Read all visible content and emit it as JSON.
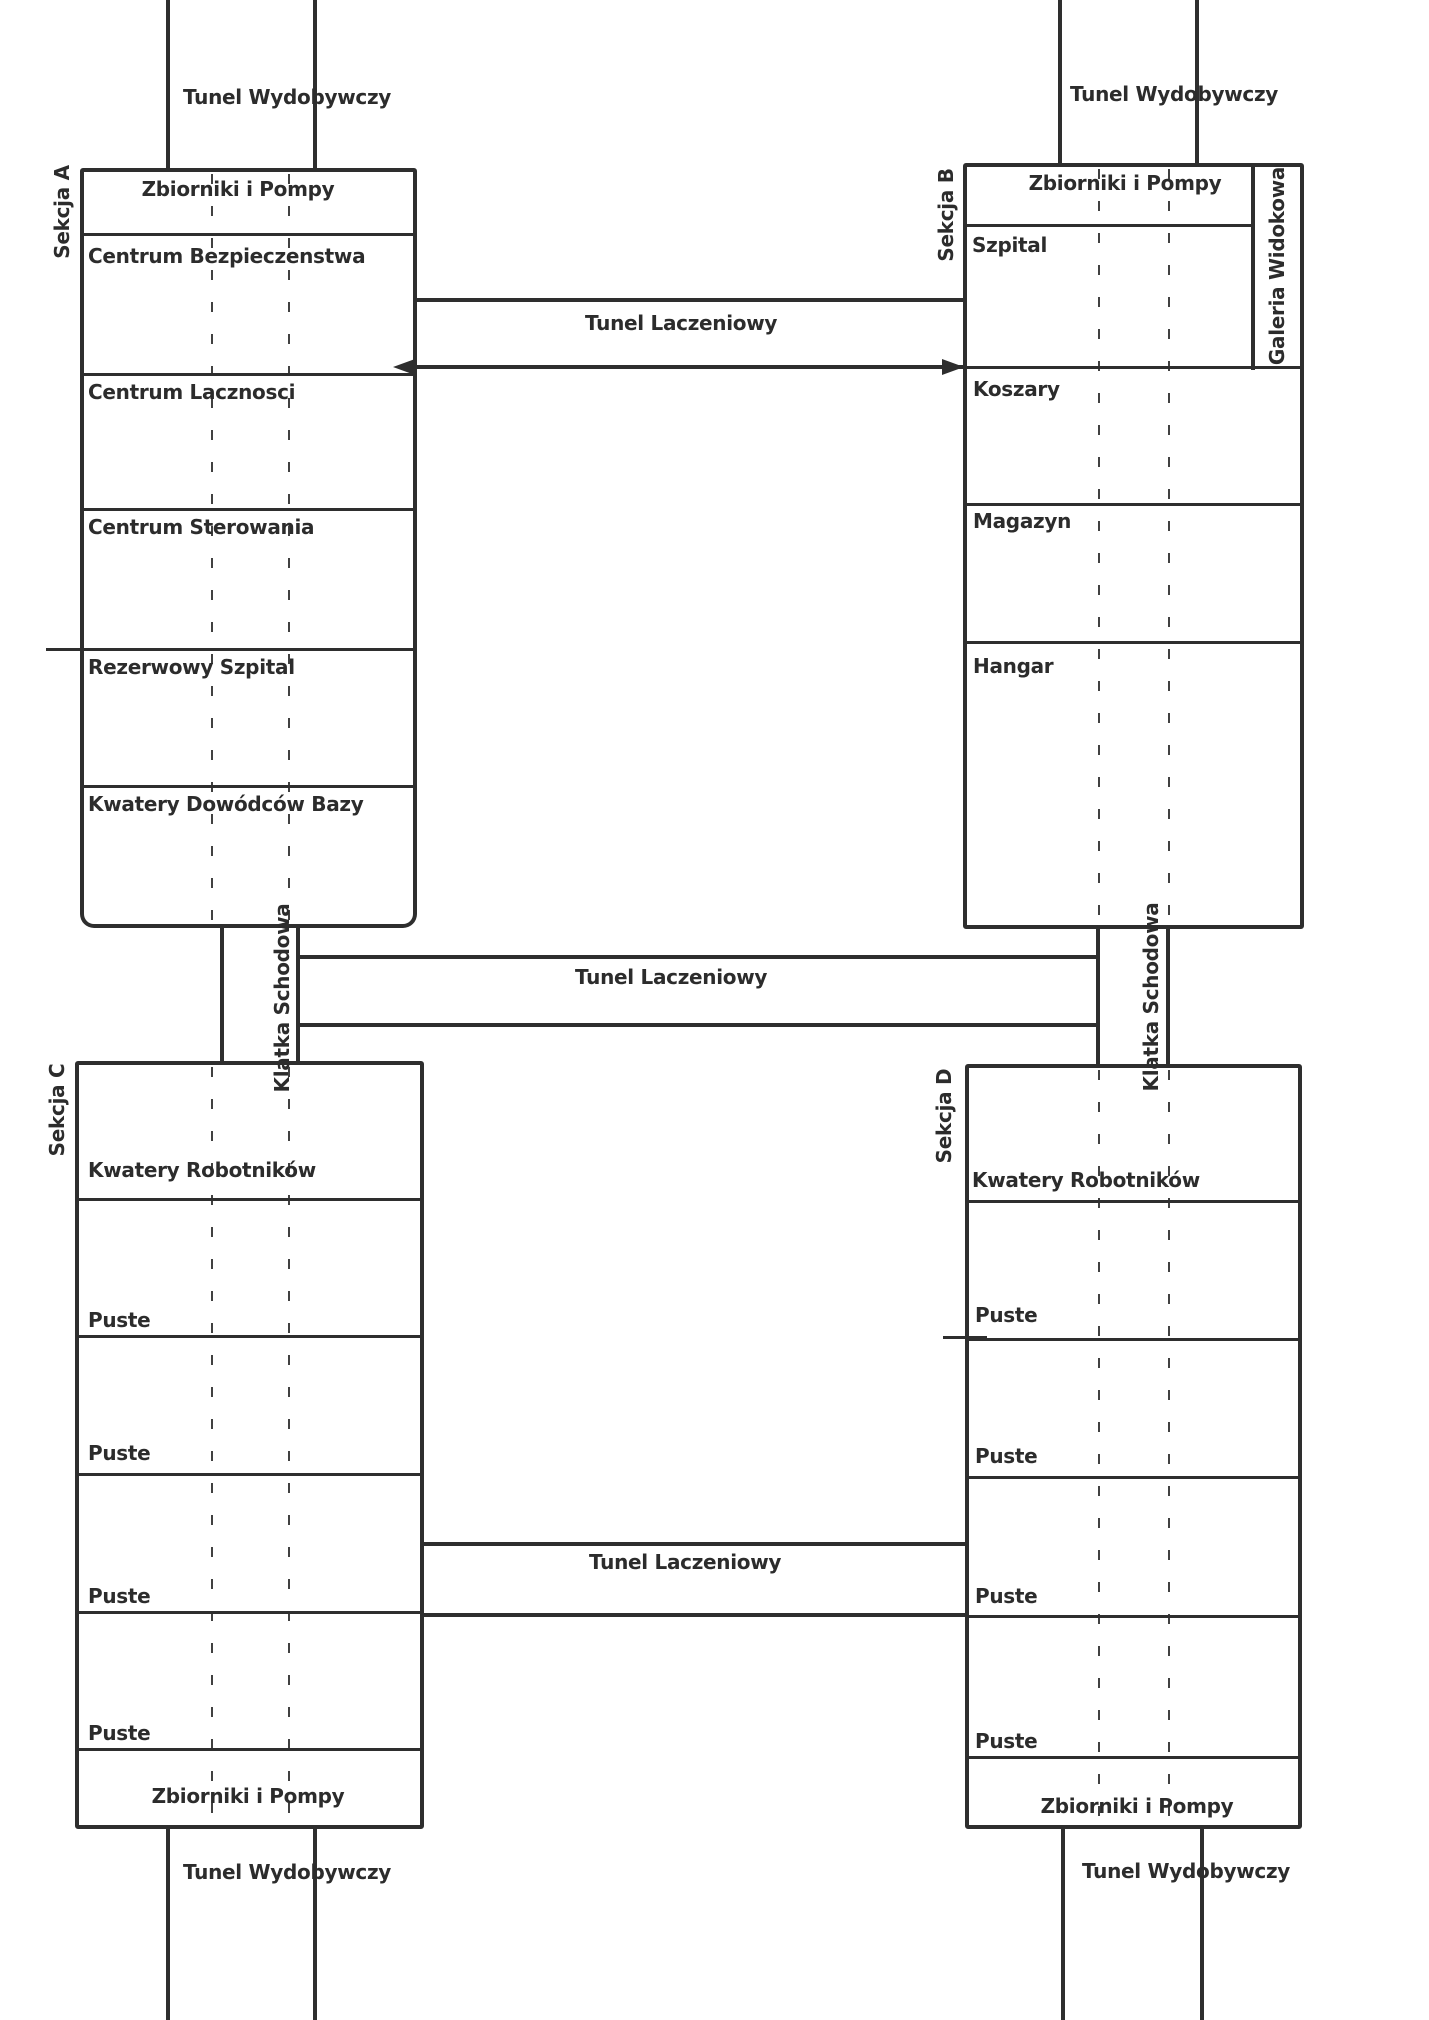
{
  "colors": {
    "ink": "#2e2e2e",
    "paper": "#ffffff"
  },
  "sections": [
    {
      "name": "Sekcja A",
      "rooms": [
        "Zbiorniki i Pompy",
        "Centrum Bezpieczenstwa",
        "Centrum Lacznosci",
        "Centrum Sterowania",
        "Rezerwowy Szpital",
        "Kwatery Dowódców Bazy"
      ]
    },
    {
      "name": "Sekcja B",
      "rooms": [
        "Zbiorniki i Pompy",
        "Szpital",
        "Koszary",
        "Magazyn",
        "Hangar"
      ],
      "gallery": "Galeria Widokowa"
    },
    {
      "name": "Sekcja C",
      "rooms": [
        "Kwatery Robotników",
        "Puste",
        "Puste",
        "Puste",
        "Puste",
        "Zbiorniki i Pompy"
      ]
    },
    {
      "name": "Sekcja D",
      "rooms": [
        "Kwatery Robotników",
        "Puste",
        "Puste",
        "Puste",
        "Puste",
        "Zbiorniki i Pompy"
      ]
    }
  ],
  "tunnels": {
    "mining": "Tunel Wydobywczy",
    "connector": "Tunel Laczeniowy",
    "staircase": "Klatka Schodowa"
  }
}
